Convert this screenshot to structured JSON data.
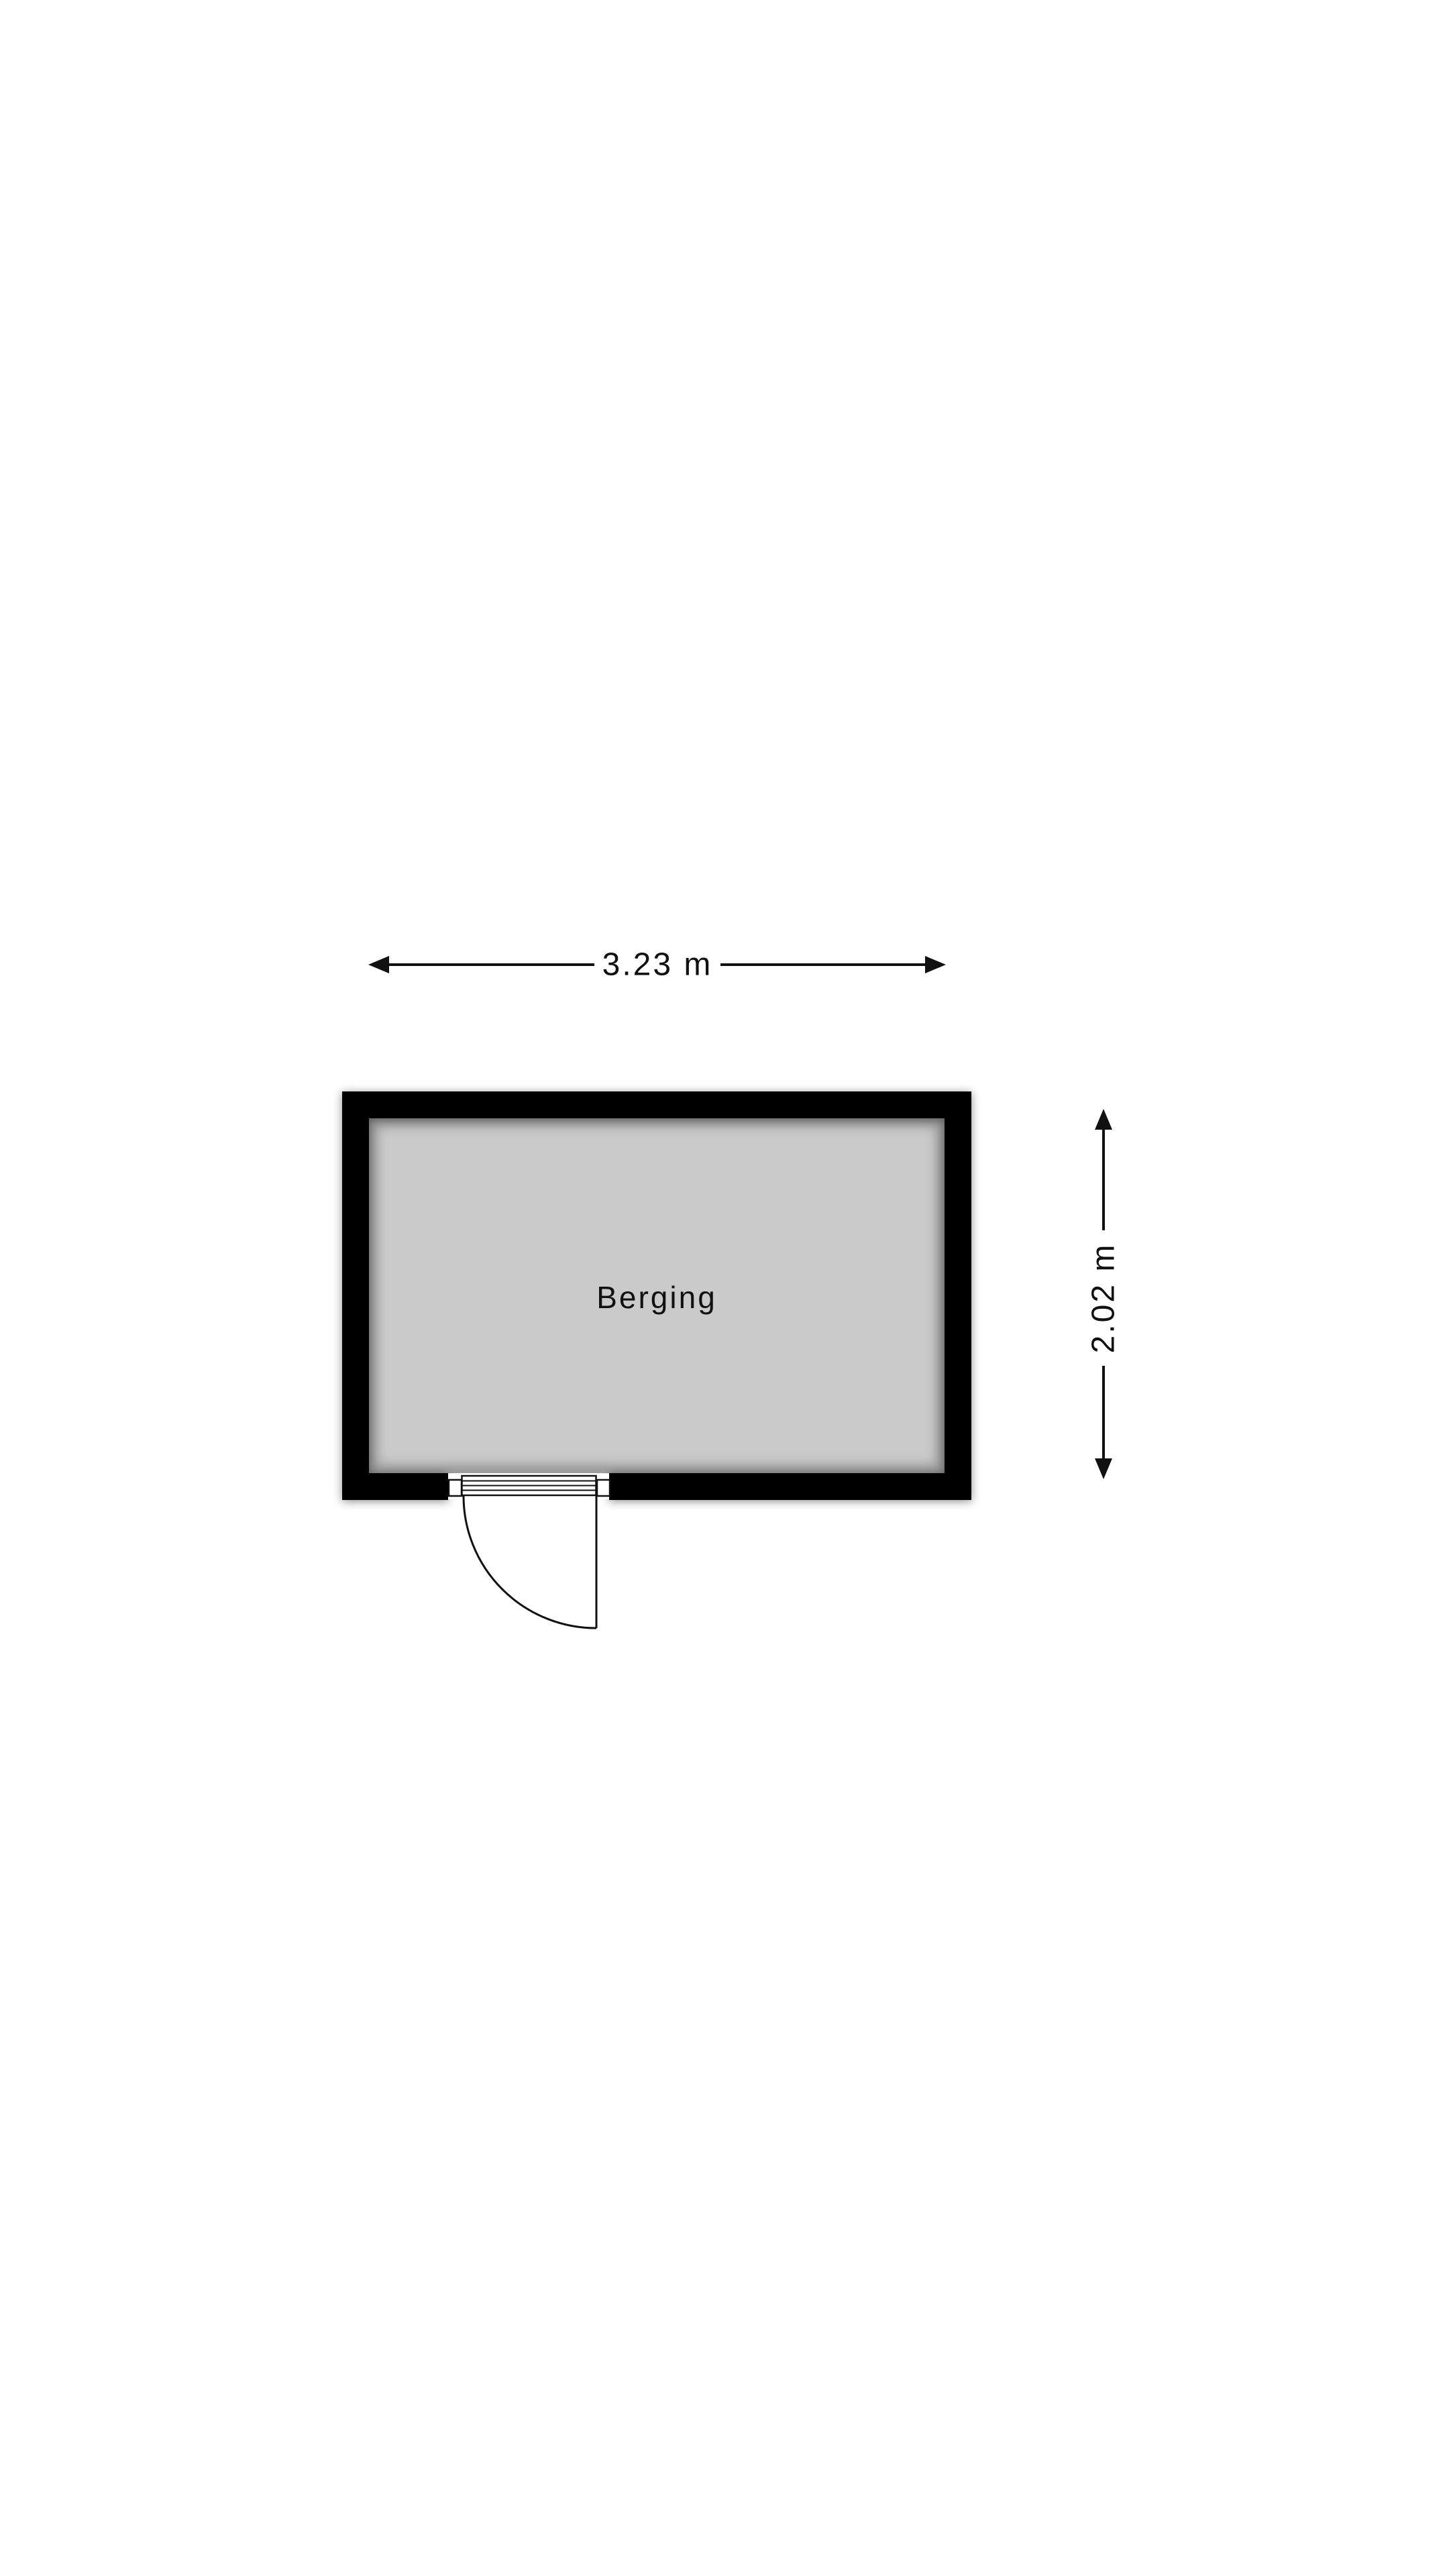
{
  "page": {
    "background_color": "#ffffff"
  },
  "floorplan": {
    "room": {
      "label": "Berging"
    },
    "dimensions": {
      "width": {
        "label": "3.23 m",
        "value": 3.23,
        "unit": "m"
      },
      "height": {
        "label": "2.02 m",
        "value": 2.02,
        "unit": "m"
      }
    },
    "colors": {
      "wall": "#000000",
      "floor": "#cacaca",
      "line": "#111111",
      "background": "#ffffff"
    }
  }
}
